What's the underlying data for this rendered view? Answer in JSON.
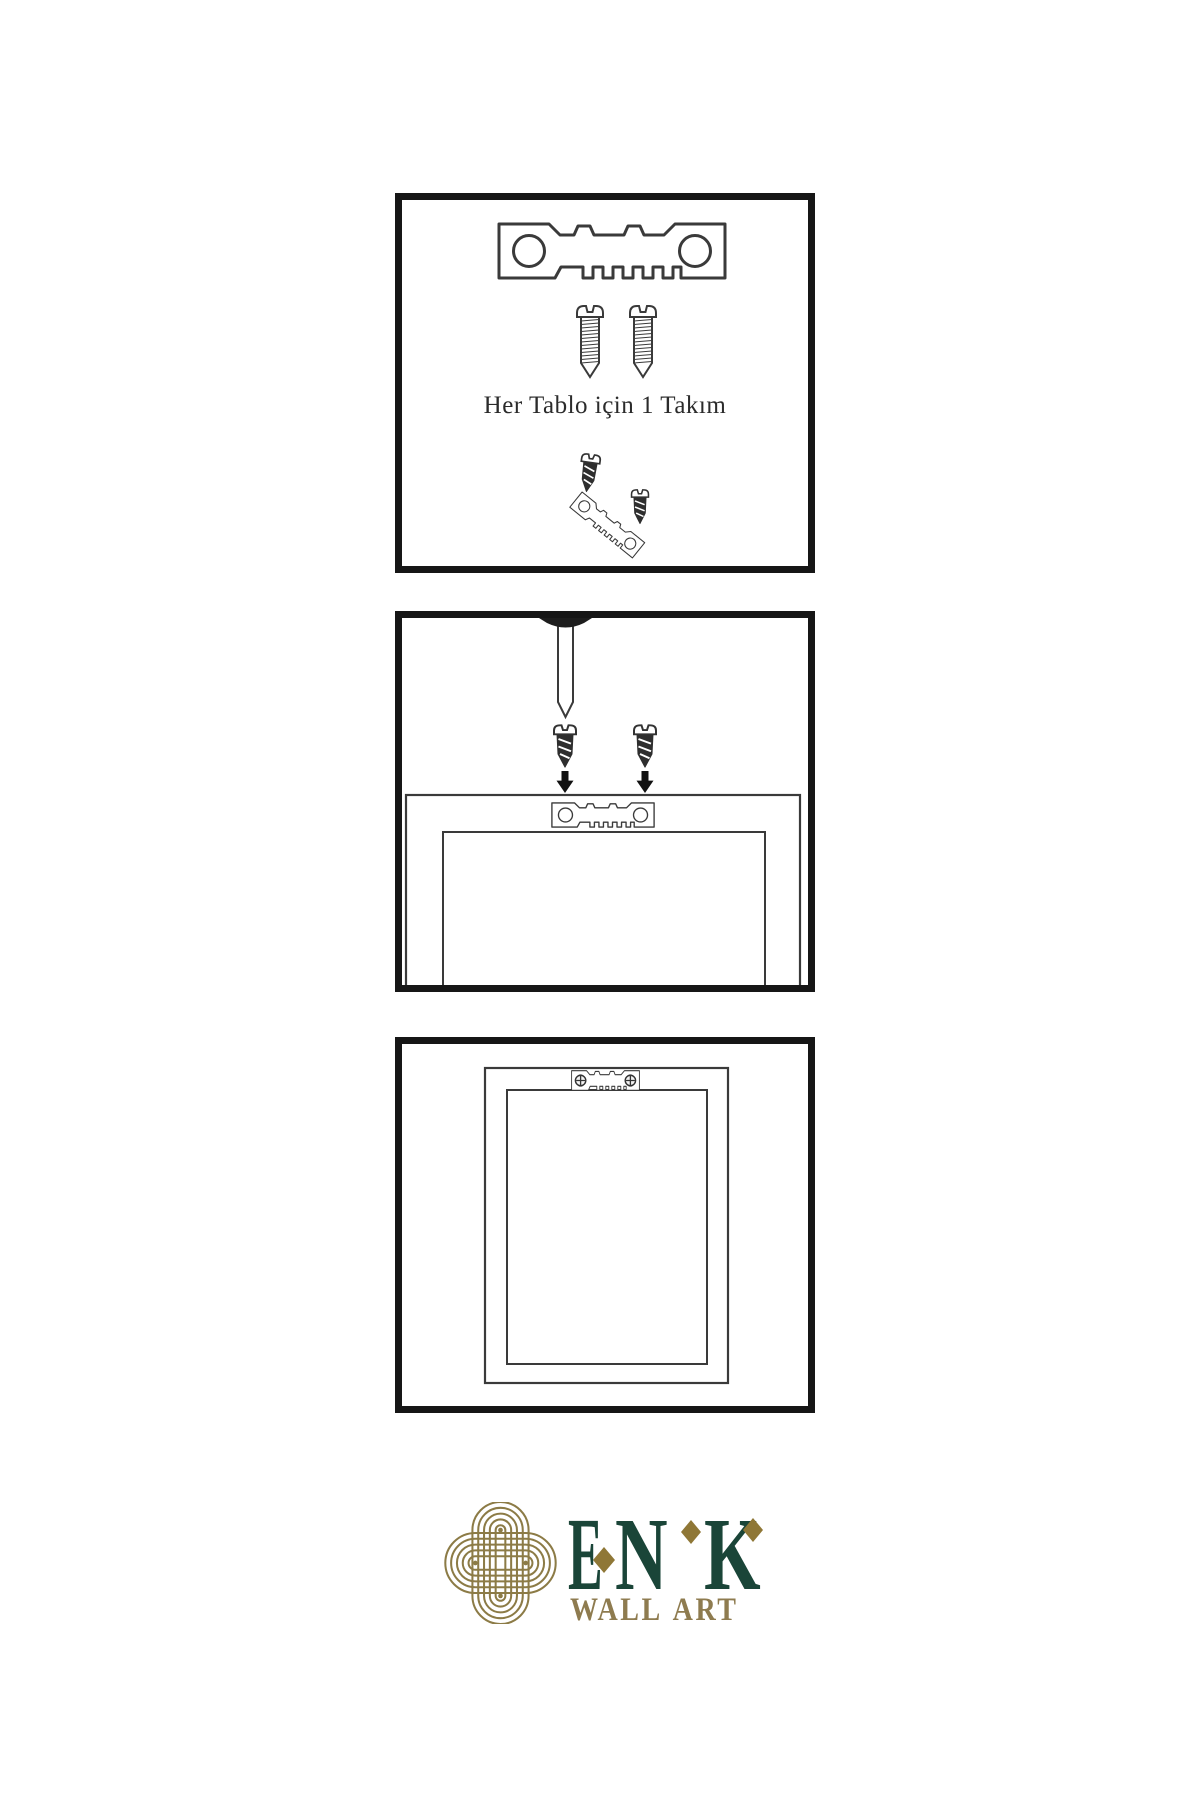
{
  "colors": {
    "background": "#ffffff",
    "panel_border": "#161616",
    "line_art": "#3a3a3a",
    "screw_dark": "#2e2e2e",
    "nail_head": "#1d1d1d",
    "arrow": "#111111",
    "logo_green": "#1a4538",
    "logo_gold": "#8c7b46",
    "logo_gold_diamond": "#8f7736",
    "logo_gold_text": "#8e7b4f"
  },
  "steps": [
    {
      "name": "hardware-set",
      "caption": "Her Tablo için 1 Takım",
      "icons": [
        "sawtooth-hanger-icon",
        "screw-icon",
        "screw-icon",
        "dark-screw-icon",
        "dark-screw-icon",
        "tilted-sawtooth-hanger-icon"
      ]
    },
    {
      "name": "attach-hanger-to-frame",
      "icons": [
        "nail-icon",
        "dark-screw-icon",
        "dark-screw-icon",
        "arrow-down-icon",
        "arrow-down-icon",
        "sawtooth-hanger-icon",
        "frame-back-icon"
      ]
    },
    {
      "name": "hanger-mounted-on-frame",
      "icons": [
        "frame-back-icon",
        "sawtooth-hanger-icon",
        "phillips-screw-head-icon",
        "phillips-screw-head-icon"
      ]
    }
  ],
  "logo": {
    "brand": "ENK",
    "letters": [
      "E",
      "N",
      "K"
    ],
    "subtitle": "WALL ART",
    "emblem": "knot-logo-icon"
  }
}
